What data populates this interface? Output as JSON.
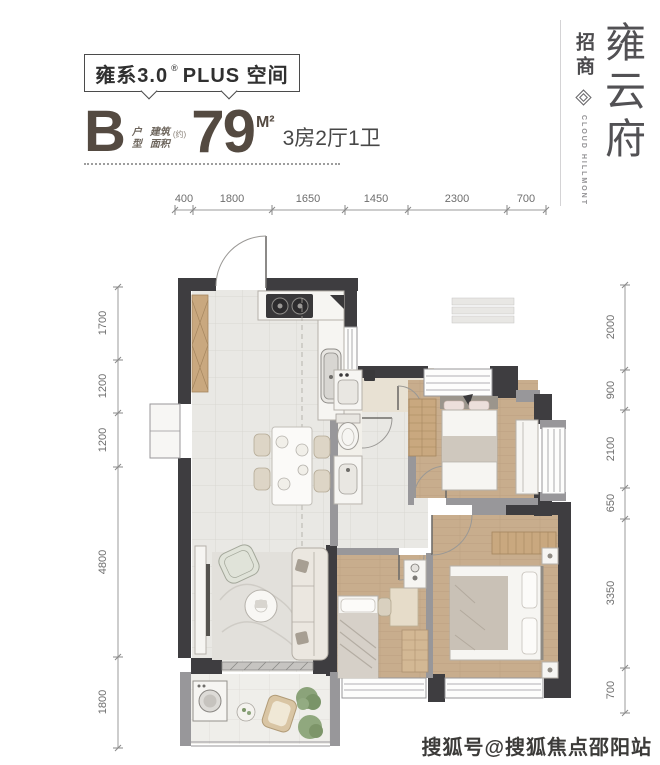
{
  "header": {
    "series_title": "雍系3.0",
    "series_reg": "®",
    "series_plus": "PLUS 空间",
    "unit_letter": "B",
    "unit_label_top": "户",
    "unit_label_bottom": "型",
    "area_label_top": "建筑",
    "area_label_bottom": "面积",
    "area_approx": "(约)",
    "area_value": "79",
    "area_unit": "M²",
    "layout_desc": "3房2厅1卫"
  },
  "branding": {
    "developer": "招商",
    "logo_icon": "diamond-knot-logo",
    "name_en": "CLOUD HILLMONT",
    "name_cn": [
      "雍",
      "云",
      "府"
    ]
  },
  "plan": {
    "dims_top": [
      "400",
      "1800",
      "1650",
      "1450",
      "2300",
      "700"
    ],
    "dims_left": [
      "1700",
      "1200",
      "1200",
      "4800",
      "1800"
    ],
    "dims_right": [
      "2000",
      "900",
      "2100",
      "650",
      "3350",
      "700"
    ]
  },
  "watermark": "搜狐号@搜狐焦点邵阳站",
  "colors": {
    "wall-dark": "#3e3d40",
    "wall-gray": "#98979a",
    "marble": "#e9e8e4",
    "marble-line": "#d9d7d2",
    "wood": "#c8ad8d",
    "wood-line": "#b79c7d",
    "bath": "#f2f0ea",
    "shower": "#e8e1d3",
    "balcony": "#efeeea",
    "furn-white": "#f6f5f2",
    "furn-stroke": "#b5b1aa",
    "wardrobe": "#c9a87f",
    "plant": "#87a076",
    "text-dark": "#303030",
    "text-brown": "#544a41",
    "dim": "#6e6e6e",
    "brand": "#525154",
    "watermark": "#3c3b39"
  }
}
